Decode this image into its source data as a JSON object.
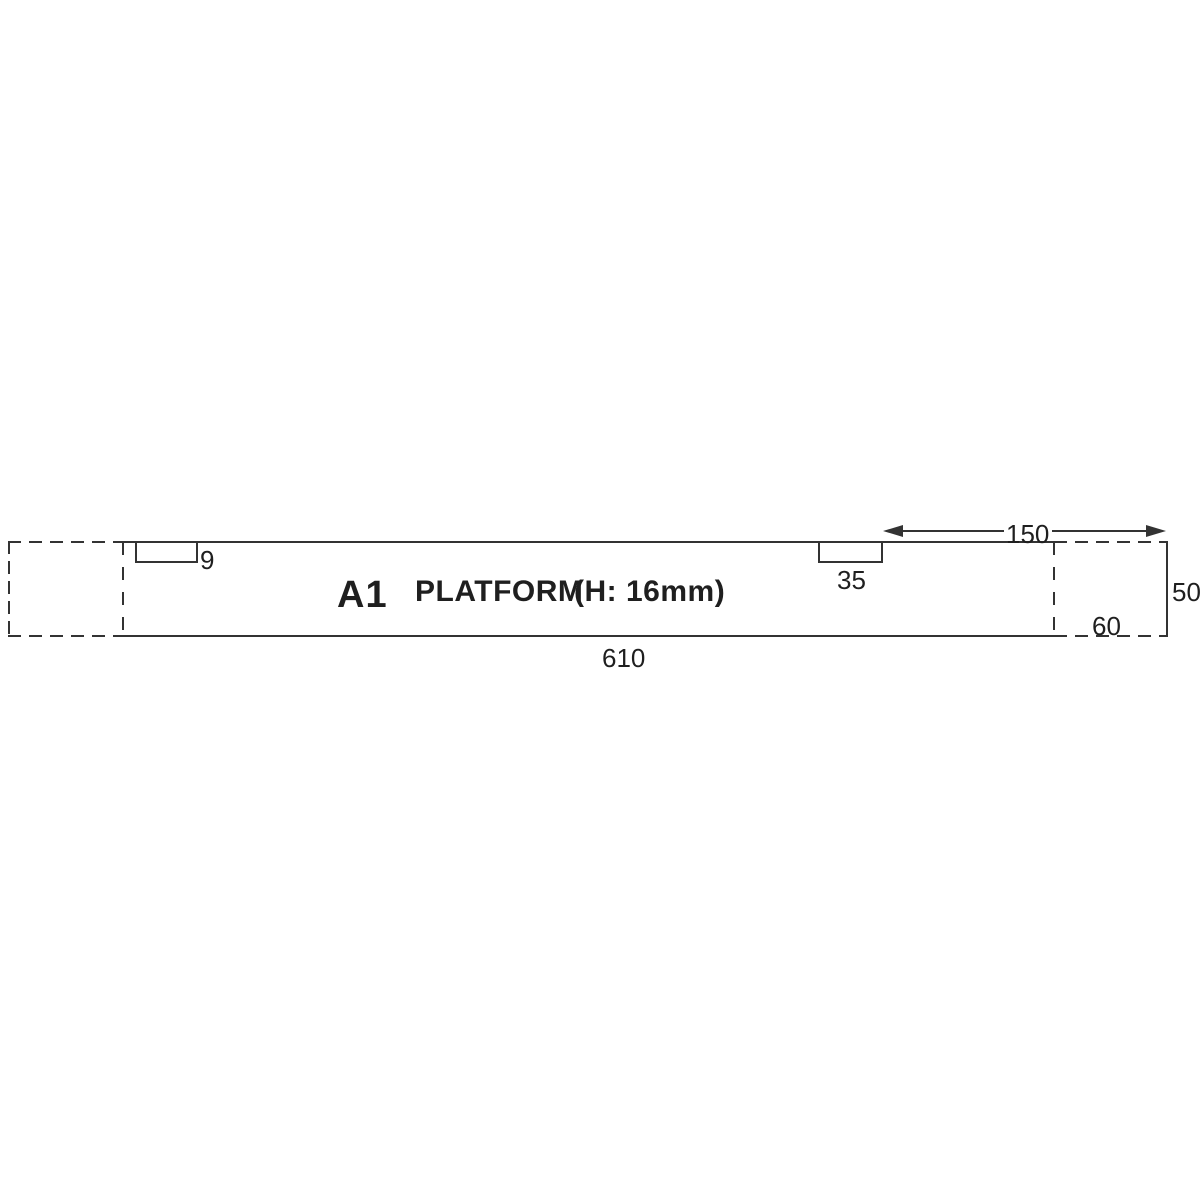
{
  "drawing": {
    "title": {
      "part_code": "A1",
      "part_name": "PLATFORM",
      "height_note": "(H: 16mm)"
    },
    "dims": {
      "length_610": "610",
      "height_50": "50",
      "offset_150": "150",
      "notch_9": "9",
      "notch_35": "35",
      "end_section_60": "60"
    },
    "colors": {
      "line": "#333333",
      "text": "#1f1f1f",
      "background": "#ffffff"
    }
  }
}
